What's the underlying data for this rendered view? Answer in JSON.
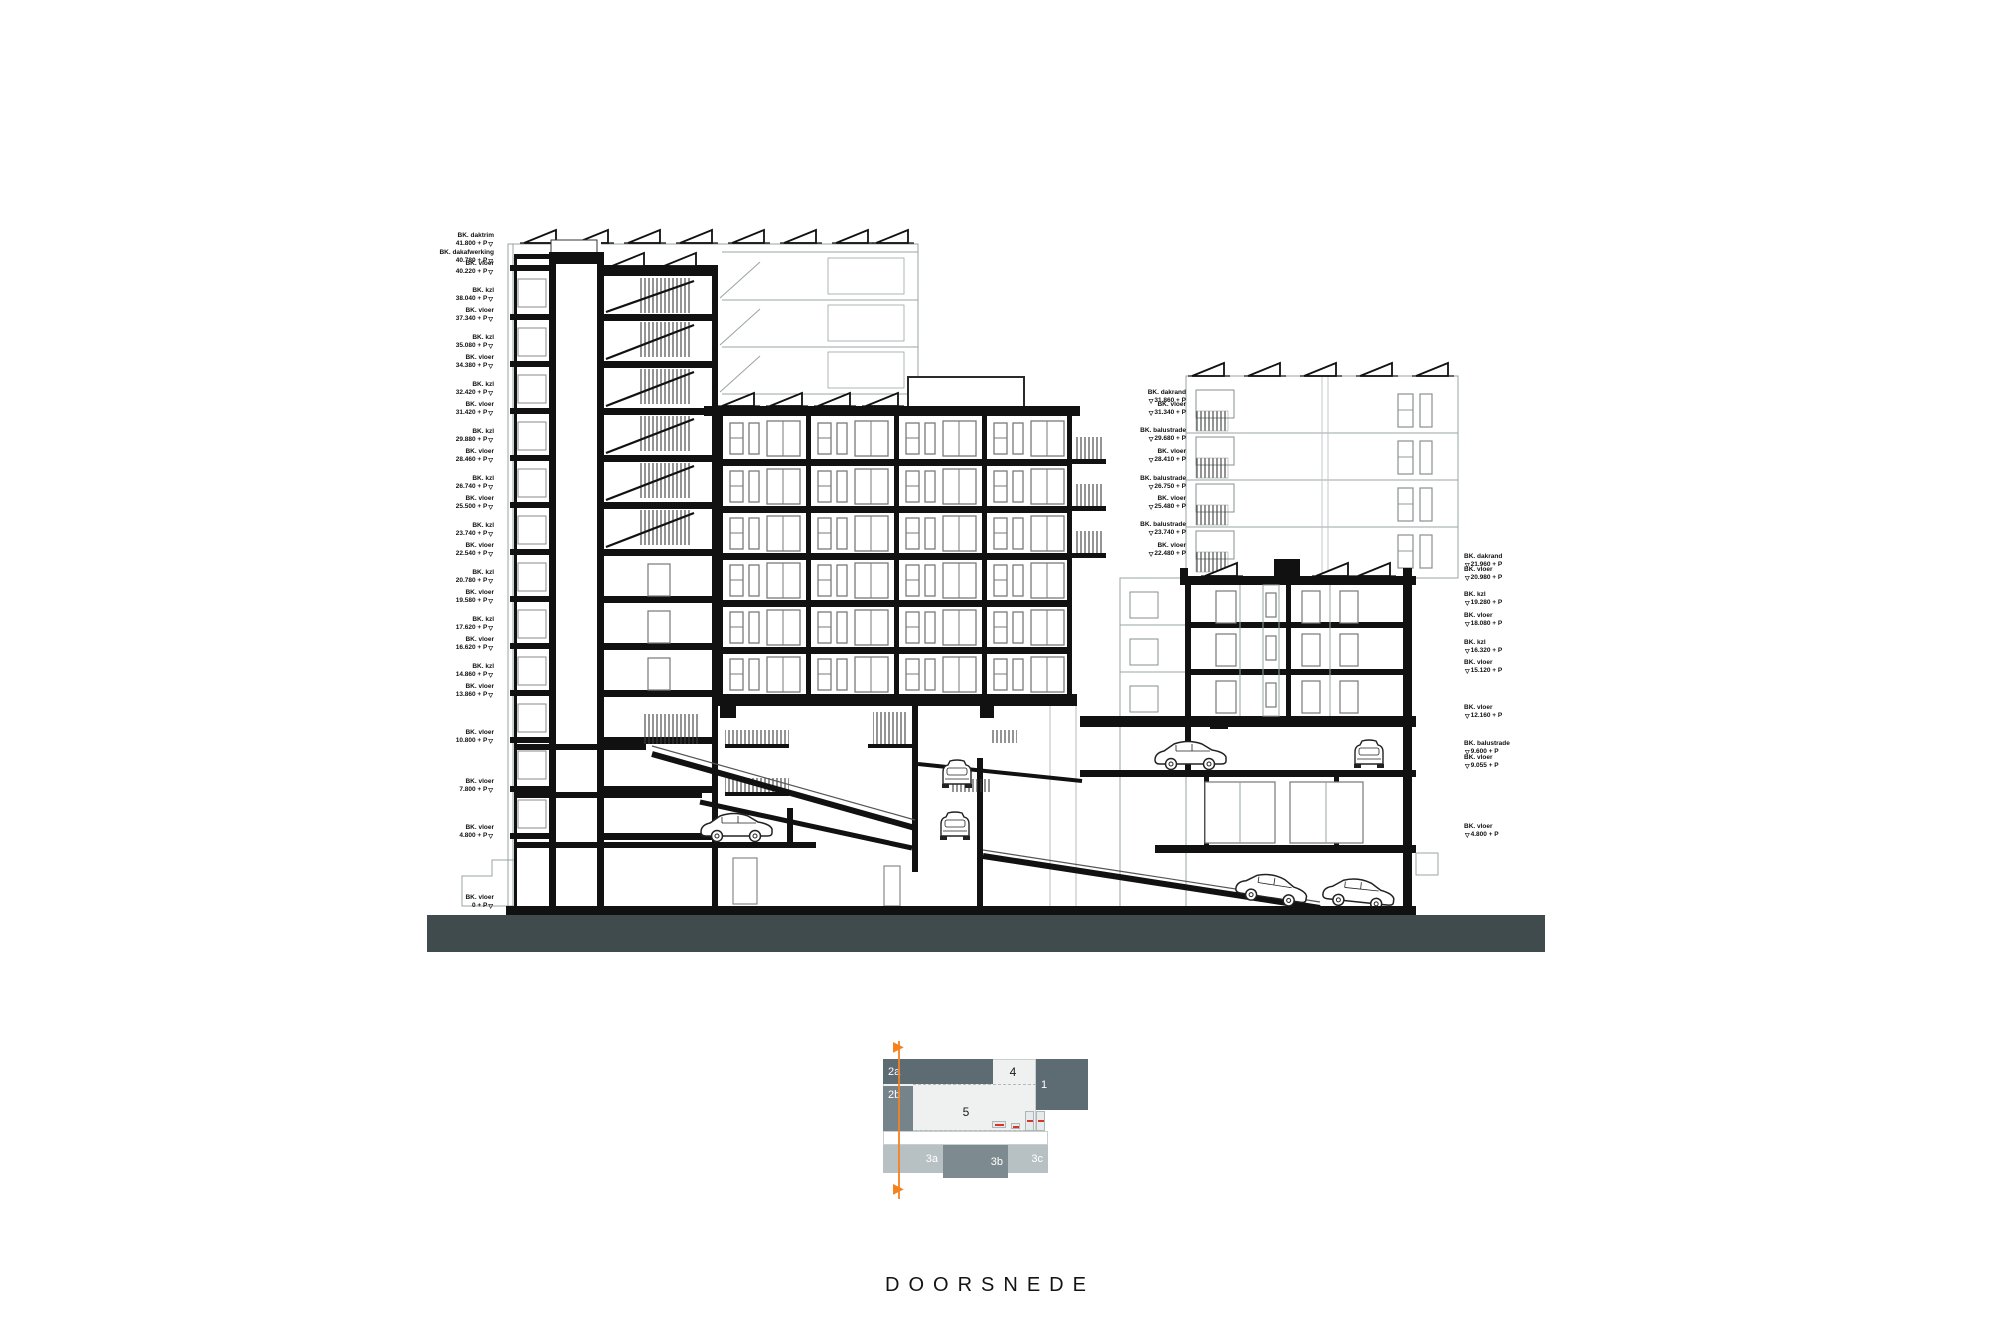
{
  "title": {
    "text": "DOORSNEDE"
  },
  "icons": {
    "level_marker": "▽",
    "section_arrow": "▶"
  },
  "colors": {
    "ground": "#3f4b4d",
    "accent_orange": "#f5821f",
    "section_red": "#d9342b",
    "plan_dark": "#5d6b73",
    "plan_medium": "#75838a",
    "plan_light": "#b7c1c4",
    "plan_bg": "#eff1f0"
  },
  "elevation_labels": {
    "left": [
      {
        "name": "BK. daktrim",
        "value": "41.800 + P",
        "y": 240
      },
      {
        "name": "BK. dakafwerking",
        "value": "40.780 + P",
        "y": 257
      },
      {
        "name": "BK. vloer",
        "value": "40.220 + P",
        "y": 268
      },
      {
        "name": "BK. kzl",
        "value": "38.040 + P",
        "y": 295
      },
      {
        "name": "BK. vloer",
        "value": "37.340 + P",
        "y": 315
      },
      {
        "name": "BK. kzl",
        "value": "35.080 + P",
        "y": 342
      },
      {
        "name": "BK. vloer",
        "value": "34.380 + P",
        "y": 362
      },
      {
        "name": "BK. kzl",
        "value": "32.420 + P",
        "y": 389
      },
      {
        "name": "BK. vloer",
        "value": "31.420 + P",
        "y": 409
      },
      {
        "name": "BK. kzl",
        "value": "29.880 + P",
        "y": 436
      },
      {
        "name": "BK. vloer",
        "value": "28.460 + P",
        "y": 456
      },
      {
        "name": "BK. kzl",
        "value": "26.740 + P",
        "y": 483
      },
      {
        "name": "BK. vloer",
        "value": "25.500 + P",
        "y": 503
      },
      {
        "name": "BK. kzl",
        "value": "23.740 + P",
        "y": 530
      },
      {
        "name": "BK. vloer",
        "value": "22.540 + P",
        "y": 550
      },
      {
        "name": "BK. kzl",
        "value": "20.780 + P",
        "y": 577
      },
      {
        "name": "BK. vloer",
        "value": "19.580 + P",
        "y": 597
      },
      {
        "name": "BK. kzl",
        "value": "17.620 + P",
        "y": 624
      },
      {
        "name": "BK. vloer",
        "value": "16.620 + P",
        "y": 644
      },
      {
        "name": "BK. kzl",
        "value": "14.860 + P",
        "y": 671
      },
      {
        "name": "BK. vloer",
        "value": "13.860 + P",
        "y": 691
      },
      {
        "name": "BK. vloer",
        "value": "10.800 + P",
        "y": 737
      },
      {
        "name": "BK. vloer",
        "value": "7.800 + P",
        "y": 786
      },
      {
        "name": "BK. vloer",
        "value": "4.800 + P",
        "y": 832
      },
      {
        "name": "BK. vloer",
        "value": "0 + P",
        "y": 902
      }
    ],
    "middle": [
      {
        "name": "BK. dakrand",
        "value": "31.860 + P",
        "y": 397
      },
      {
        "name": "BK. vloer",
        "value": "31.340 + P",
        "y": 409
      },
      {
        "name": "BK. balustrade",
        "value": "29.680 + P",
        "y": 435
      },
      {
        "name": "BK. vloer",
        "value": "28.410 + P",
        "y": 456
      },
      {
        "name": "BK. balustrade",
        "value": "26.750 + P",
        "y": 483
      },
      {
        "name": "BK. vloer",
        "value": "25.480 + P",
        "y": 503
      },
      {
        "name": "BK. balustrade",
        "value": "23.740 + P",
        "y": 529
      },
      {
        "name": "BK. vloer",
        "value": "22.480 + P",
        "y": 550
      }
    ],
    "right": [
      {
        "name": "BK. dakrand",
        "value": "21.960 + P",
        "y": 561
      },
      {
        "name": "BK. vloer",
        "value": "20.980 + P",
        "y": 574
      },
      {
        "name": "BK. kzl",
        "value": "19.280 + P",
        "y": 599
      },
      {
        "name": "BK. vloer",
        "value": "18.080 + P",
        "y": 620
      },
      {
        "name": "BK. kzl",
        "value": "16.320 + P",
        "y": 647
      },
      {
        "name": "BK. vloer",
        "value": "15.120 + P",
        "y": 667
      },
      {
        "name": "BK. vloer",
        "value": "12.160 + P",
        "y": 712
      },
      {
        "name": "BK. balustrade",
        "value": "9.600 + P",
        "y": 748
      },
      {
        "name": "BK. vloer",
        "value": "9.055 + P",
        "y": 762
      },
      {
        "name": "BK. vloer",
        "value": "4.800 + P",
        "y": 831
      }
    ]
  },
  "key_plan": {
    "blocks": [
      {
        "id": "2a",
        "label": "2a"
      },
      {
        "id": "2b",
        "label": "2b"
      },
      {
        "id": "4",
        "label": "4"
      },
      {
        "id": "1",
        "label": "1"
      },
      {
        "id": "5",
        "label": "5"
      },
      {
        "id": "3a",
        "label": "3a"
      },
      {
        "id": "3b",
        "label": "3b"
      },
      {
        "id": "3c",
        "label": "3c"
      }
    ]
  }
}
